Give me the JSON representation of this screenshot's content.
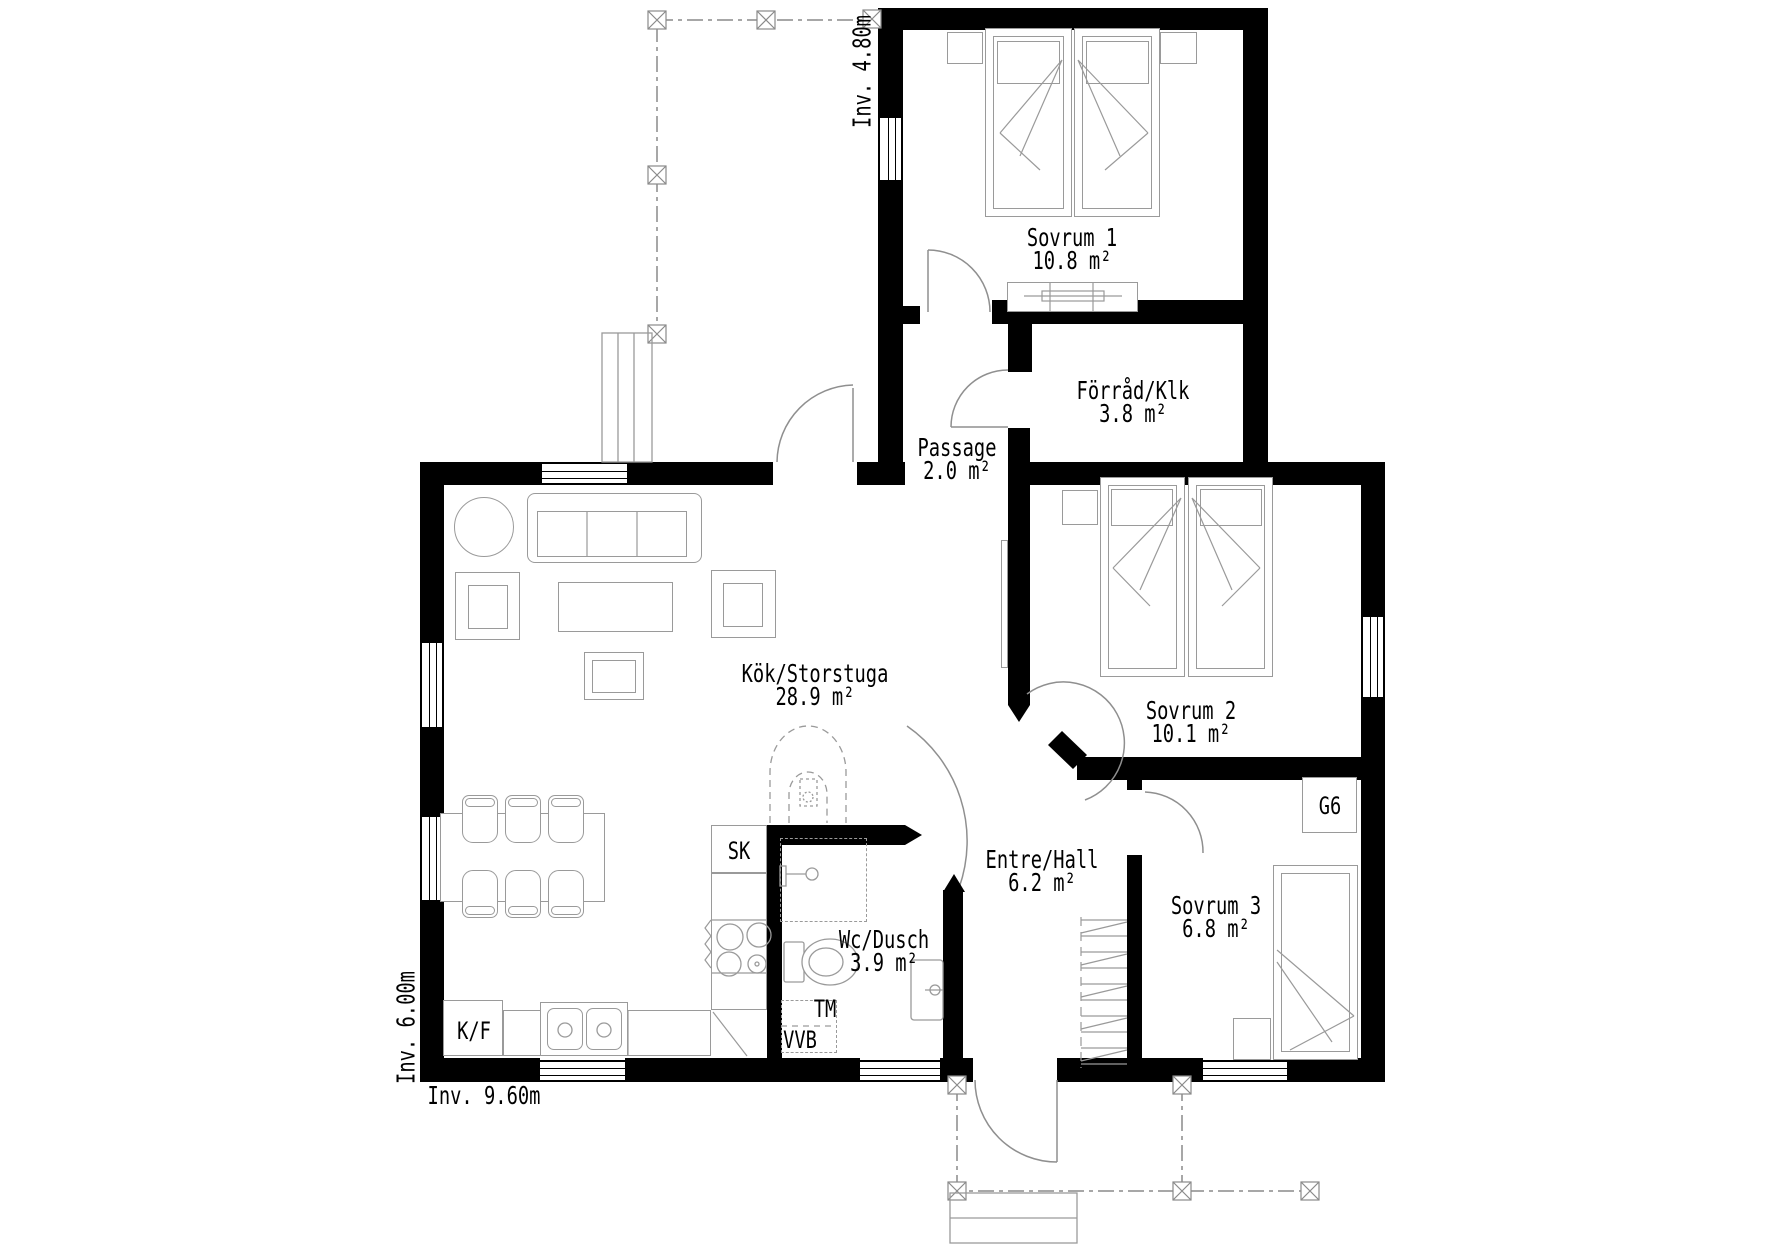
{
  "plan": {
    "rooms": [
      {
        "id": "sovrum-1",
        "name": "Sovrum 1",
        "area": "10.8 m²"
      },
      {
        "id": "forrad-klk",
        "name": "Förråd/Klk",
        "area": "3.8 m²"
      },
      {
        "id": "passage",
        "name": "Passage",
        "area": "2.0 m²"
      },
      {
        "id": "kok-storstuga",
        "name": "Kök/Storstuga",
        "area": "28.9 m²"
      },
      {
        "id": "sovrum-2",
        "name": "Sovrum 2",
        "area": "10.1 m²"
      },
      {
        "id": "entre-hall",
        "name": "Entre/Hall",
        "area": "6.2 m²"
      },
      {
        "id": "sovrum-3",
        "name": "Sovrum 3",
        "area": "6.8 m²"
      },
      {
        "id": "wc-dusch",
        "name": "Wc/Dusch",
        "area": "3.9 m²"
      }
    ],
    "fixtures": {
      "sk": "SK",
      "tm": "TM",
      "vvb": "VVB",
      "kf": "K/F",
      "g6": "G6"
    },
    "dimensions": {
      "gable": "Inv. 4.80m",
      "side": "Inv. 6.00m",
      "front": "Inv. 9.60m"
    },
    "colors": {
      "wall": "#000000",
      "furniture_line": "#9a9a9a",
      "background": "#ffffff"
    }
  }
}
